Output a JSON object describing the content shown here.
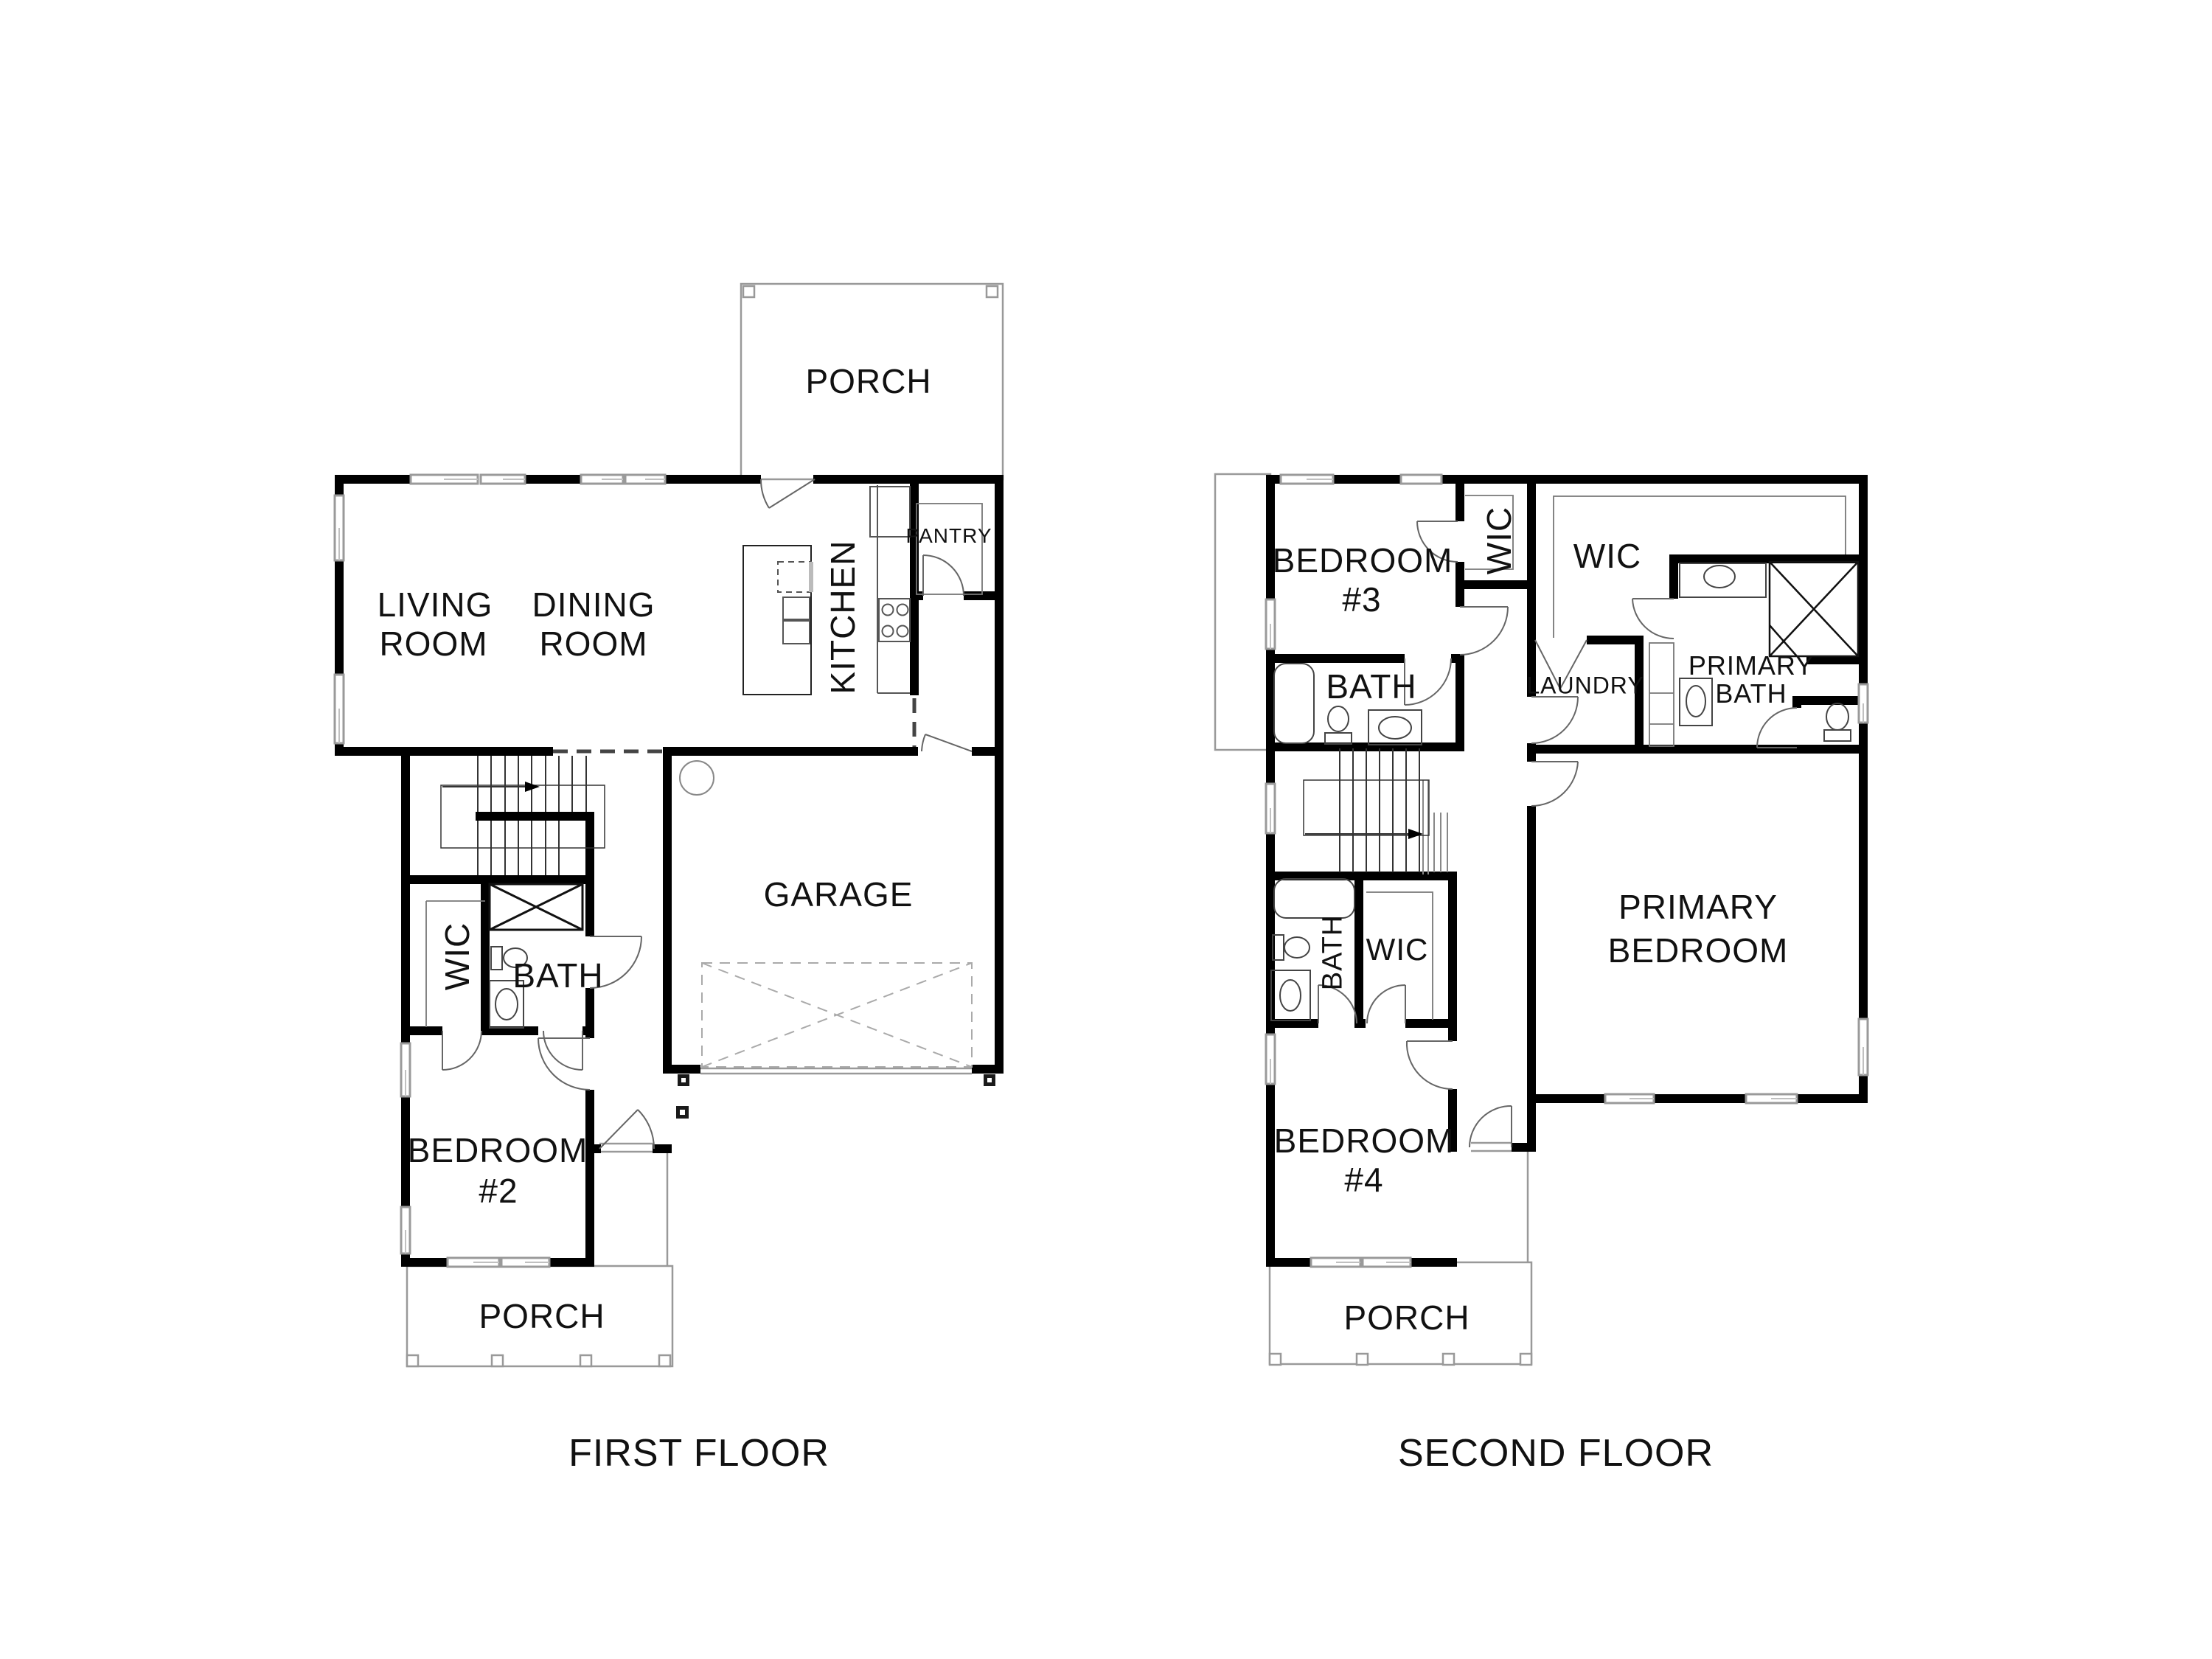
{
  "document": {
    "type": "architectural-floor-plan",
    "background_color": "#ffffff",
    "wall_color": "#000000",
    "thin_line_color": "#555555",
    "porch_line_color": "#999999"
  },
  "floor1": {
    "title": "FIRST FLOOR",
    "labels": {
      "porch_top": "PORCH",
      "living1": "LIVING",
      "living2": "ROOM",
      "dining1": "DINING",
      "dining2": "ROOM",
      "kitchen": "KITCHEN",
      "pantry": "PANTRY",
      "wic": "WIC",
      "bath": "BATH",
      "bedroom2_1": "BEDROOM",
      "bedroom2_2": "#2",
      "garage": "GARAGE",
      "porch_bottom": "PORCH"
    }
  },
  "floor2": {
    "title": "SECOND FLOOR",
    "labels": {
      "bedroom3_1": "BEDROOM",
      "bedroom3_2": "#3",
      "wic_small": "WIC",
      "wic_large": "WIC",
      "bath_upper": "BATH",
      "laundry": "LAUNDRY",
      "primary_bath1": "PRIMARY",
      "primary_bath2": "BATH",
      "bath_lower": "BATH",
      "wic_lower": "WIC",
      "primary_bedroom1": "PRIMARY",
      "primary_bedroom2": "BEDROOM",
      "bedroom4_1": "BEDROOM",
      "bedroom4_2": "#4",
      "porch": "PORCH"
    }
  }
}
